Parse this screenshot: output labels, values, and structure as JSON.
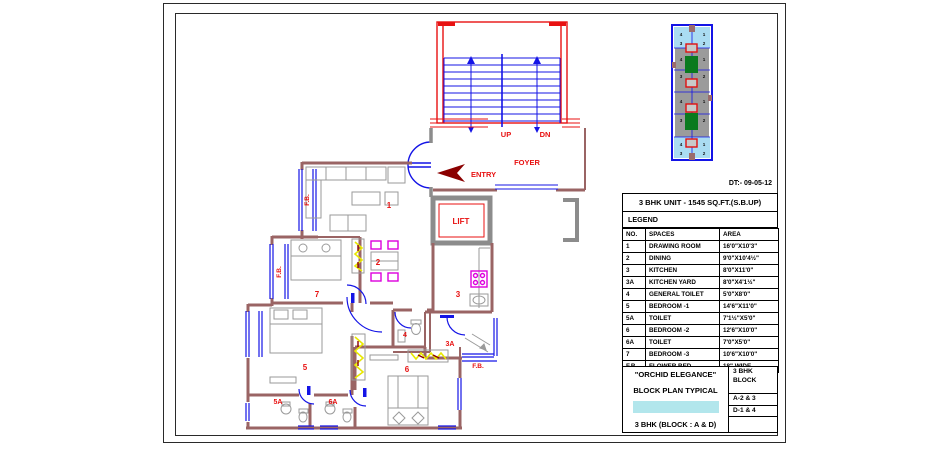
{
  "sheet": {
    "date": "DT:- 09-05-12"
  },
  "legend": {
    "unit_title": "3 BHK UNIT - 1545 SQ.FT.(S.B.UP)",
    "title": "LEGEND",
    "columns": [
      "NO.",
      "SPACES",
      "AREA"
    ],
    "rows": [
      {
        "no": "1",
        "space": "DRAWING ROOM",
        "area": "16'0\"X10'3\""
      },
      {
        "no": "2",
        "space": "DINING",
        "area": "9'0\"X10'4½\""
      },
      {
        "no": "3",
        "space": "KITCHEN",
        "area": "8'0\"X11'0\""
      },
      {
        "no": "3A",
        "space": "KITCHEN YARD",
        "area": "8'0\"X4'1½\""
      },
      {
        "no": "4",
        "space": "GENERAL TOILET",
        "area": "5'0\"X8'0\""
      },
      {
        "no": "5",
        "space": "BEDROOM -1",
        "area": "14'6\"X11'0\""
      },
      {
        "no": "5A",
        "space": "TOILET",
        "area": "7'1½\"X5'0\""
      },
      {
        "no": "6",
        "space": "BEDROOM -2",
        "area": "12'6\"X10'0\""
      },
      {
        "no": "6A",
        "space": "TOILET",
        "area": "7'0\"X5'0\""
      },
      {
        "no": "7",
        "space": "BEDROOM -3",
        "area": "10'6\"X10'0\""
      },
      {
        "no": "F.B.",
        "space": "FLOWER BED",
        "area": "18\" WIDE"
      }
    ]
  },
  "title_block": {
    "project": "\"ORCHID ELEGANCE\"",
    "subtitle": "BLOCK PLAN TYPICAL",
    "plan": "3 BHK (BLOCK : A & D)",
    "block_label_1": "3 BHK",
    "block_label_2": "BLOCK",
    "block_a": "A-2 & 3",
    "block_d": "D-1 & 4",
    "highlight_color": "#b2e6ec"
  },
  "plan": {
    "labels": {
      "drawing_room": "1",
      "dining": "2",
      "kitchen": "3",
      "kitchen_yard": "3A",
      "general_toilet": "4",
      "bedroom1": "5",
      "toilet_5a": "5A",
      "bedroom2": "6",
      "toilet_6a": "6A",
      "bedroom3": "7",
      "lift": "LIFT",
      "up": "UP",
      "dn": "DN",
      "foyer": "FOYER",
      "entry": "ENTRY",
      "fb1": "F.B.",
      "fb2": "F.B.",
      "fb3": "F.B."
    }
  },
  "key_plan": {
    "sections": [
      {
        "cells": [
          "4",
          "1",
          "3",
          "2"
        ]
      },
      {
        "cells": [
          "4",
          "1",
          "3",
          "2"
        ]
      },
      {
        "cells": [
          "4",
          "1",
          "3",
          "2"
        ]
      },
      {
        "cells": [
          "4",
          "1",
          "3",
          "2"
        ]
      }
    ]
  },
  "colors": {
    "wall_brown": "#9a6464",
    "wall_gray": "#8c8c8c",
    "cad_blue": "#1414e6",
    "label_red": "#e81111",
    "entry_arrow": "#8b0000",
    "furniture_gray": "#9a9a9a",
    "fixture_magenta": "#dd00dd",
    "wardrobe_yellow": "#e8e800",
    "highlight_cyan": "#b2e6ec"
  }
}
